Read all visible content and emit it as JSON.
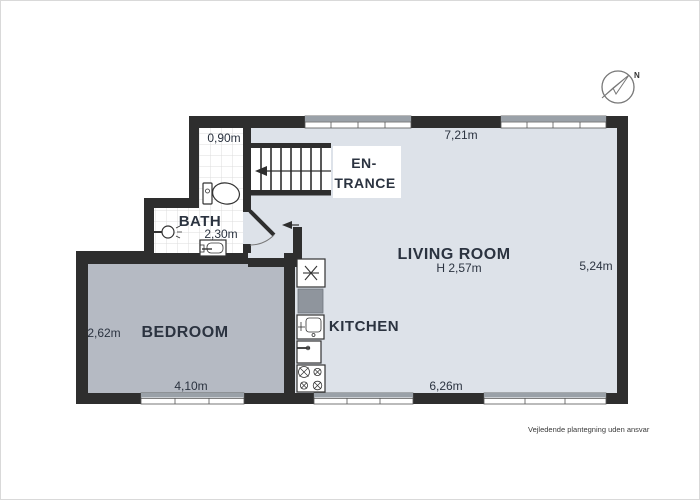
{
  "floor_plan": {
    "rooms": {
      "entrance": {
        "label_line1": "EN-",
        "label_line2": "TRANCE"
      },
      "bath": {
        "label": "BATH",
        "width": "0,90m",
        "size": "2,30m",
        "fixtures": [
          "toilet",
          "wall-sink",
          "washbasin"
        ]
      },
      "bedroom": {
        "label": "BEDROOM",
        "depth": "2,62m",
        "width": "4,10m"
      },
      "kitchen": {
        "label": "KITCHEN",
        "fixtures": [
          "refrigerator",
          "countertop",
          "kitchen-sink",
          "dishwasher",
          "stove"
        ]
      },
      "living_room": {
        "label": "LIVING ROOM",
        "ceiling_height": "H 2,57m",
        "top_width": "7,21m",
        "right_depth": "5,24m",
        "bottom_width": "6,26m"
      },
      "stairs": {
        "fixtures": [
          "staircase",
          "direction-arrow"
        ]
      }
    },
    "compass": {
      "north_label": "N"
    },
    "footer": {
      "disclaimer": "Vejledende plantegning uden ansvar"
    },
    "colors": {
      "wall": "#2e2e2e",
      "living_room_floor": "#dde2e9",
      "bedroom_floor": "#b5bac3",
      "bath_floor": "#ffffff",
      "tile_grid": "#dcdcdc",
      "countertop": "#8f959d",
      "label_text": "#2b3340"
    }
  }
}
